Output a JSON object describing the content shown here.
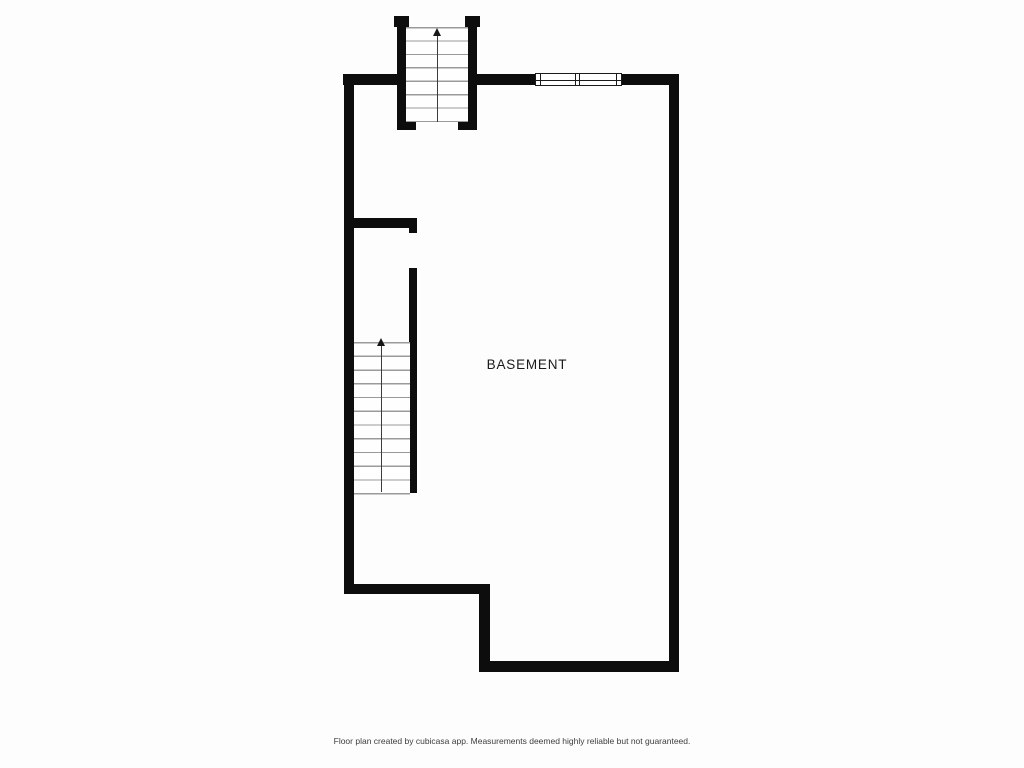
{
  "page": {
    "background_color": "#fdfdfd"
  },
  "floor_plan": {
    "type": "basement-floor-plan",
    "room": {
      "label": "BASEMENT"
    },
    "colors": {
      "wall": "#0d0d0d",
      "stair_tread": "#9a9a9a",
      "room_label": "#1b1b1b",
      "footer_text": "#3d3d3d"
    },
    "stairs": [
      {
        "id": "entry-staircase",
        "location": "top",
        "direction_icon": "arrow-up-icon",
        "treads": 8
      },
      {
        "id": "basement-staircase",
        "location": "left",
        "direction_icon": "arrow-up-icon",
        "treads": 12
      }
    ],
    "windows": [
      {
        "id": "top-wall-window",
        "panes": 2
      }
    ]
  },
  "footer": {
    "text": "Floor plan created by cubicasa app. Measurements deemed highly reliable but not guaranteed."
  }
}
